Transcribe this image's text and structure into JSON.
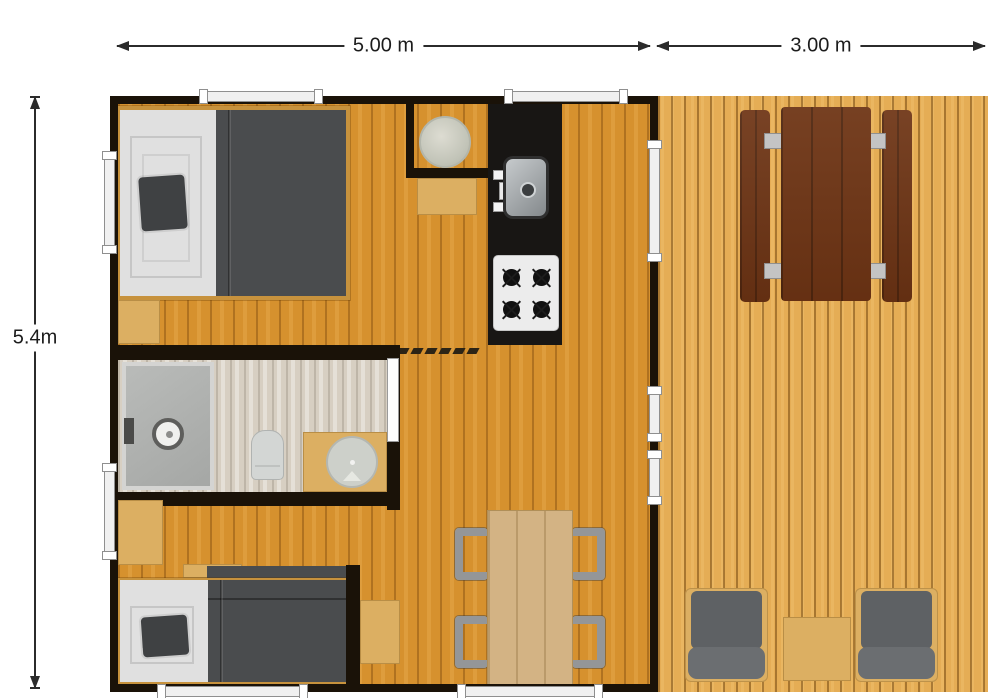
{
  "dimensions": {
    "top_main": "5.00 m",
    "top_deck": "3.00 m",
    "left_height": "5.4m"
  },
  "palette": {
    "wall": "#1a1208",
    "floor-wood": "#d6912e",
    "deck-wood": "#e5ad55",
    "bath-floor": "#d7cfc2",
    "counter-black": "#181614",
    "duvet": "#4a4c4e",
    "sheet": "#e0e0e0",
    "pillow": "#3f4143",
    "tan-furniture": "#dcaf62",
    "table-wood": "#d3b384",
    "picnic-brown": "#6e3414",
    "chair-gray": "#949698",
    "cushion-gray": "#5e6164",
    "window-fill": "#f0f0f0",
    "window-border": "#8f8f8f",
    "dim-line": "#2b2b2b"
  }
}
